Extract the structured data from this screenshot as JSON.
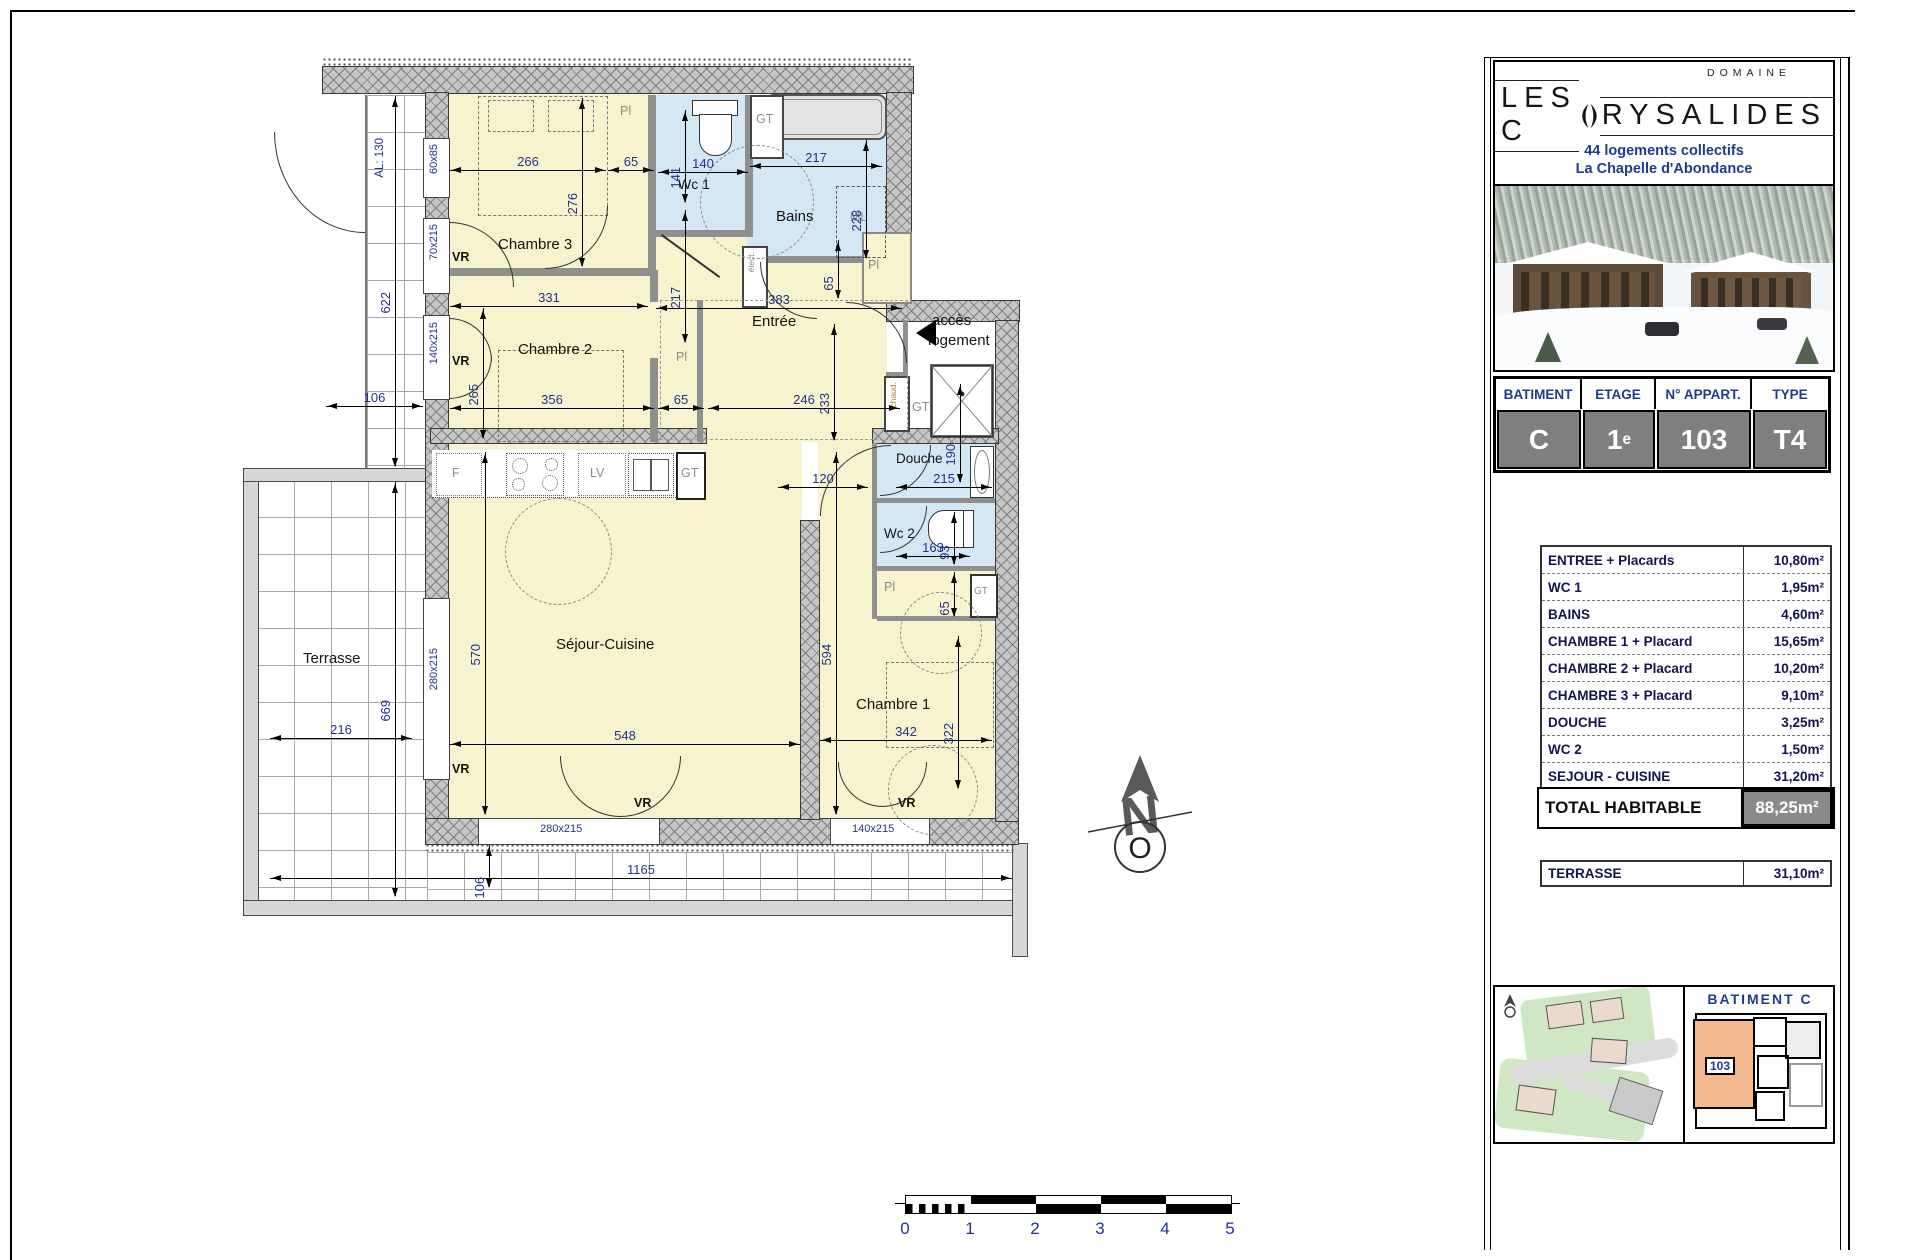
{
  "header": {
    "domaine": "DOMAINE",
    "title_left": "LES C",
    "title_right": "RYSALIDES",
    "subtitle1": "44 logements collectifs",
    "subtitle2": "La Chapelle d'Abondance"
  },
  "info": {
    "headers": [
      "BATIMENT",
      "ETAGE",
      "N° APPART.",
      "TYPE"
    ],
    "batiment": "C",
    "etage": "1",
    "etage_sup": "e",
    "appart": "103",
    "type": "T4"
  },
  "areas": {
    "rows": [
      {
        "label": "ENTREE + Placards",
        "value": "10,80m²"
      },
      {
        "label": "WC 1",
        "value": "1,95m²"
      },
      {
        "label": "BAINS",
        "value": "4,60m²"
      },
      {
        "label": "CHAMBRE 1 + Placard",
        "value": "15,65m²"
      },
      {
        "label": "CHAMBRE 2 + Placard",
        "value": "10,20m²"
      },
      {
        "label": "CHAMBRE 3 + Placard",
        "value": "9,10m²"
      },
      {
        "label": "DOUCHE",
        "value": "3,25m²"
      },
      {
        "label": "WC 2",
        "value": "1,50m²"
      },
      {
        "label": "SEJOUR - CUISINE",
        "value": "31,20m²"
      }
    ],
    "total_label": "TOTAL HABITABLE",
    "total_value": "88,25m²",
    "terrasse_label": "TERRASSE",
    "terrasse_value": "31,10m²"
  },
  "site": {
    "batiment_title": "BATIMENT  C",
    "apt_badge": "103"
  },
  "compass": {
    "n": "N",
    "o": "O"
  },
  "scalebar": {
    "ticks": [
      "0",
      "1",
      "2",
      "3",
      "4",
      "5"
    ]
  },
  "plan": {
    "rooms": {
      "chambre3": "Chambre 3",
      "chambre2": "Chambre 2",
      "wc1": "Wc 1",
      "bains": "Bains",
      "entree": "Entrée",
      "douche": "Douche",
      "wc2": "Wc 2",
      "sejour": "Séjour-Cuisine",
      "chambre1": "Chambre 1",
      "terrasse": "Terrasse"
    },
    "dims": [
      "266",
      "65",
      "140",
      "141",
      "217",
      "228",
      "276",
      "331",
      "383",
      "217",
      "265",
      "356",
      "65",
      "246",
      "106",
      "233",
      "65",
      "120",
      "215",
      "190",
      "163",
      "93",
      "65",
      "570",
      "548",
      "594",
      "342",
      "322",
      "622",
      "669",
      "216",
      "1165",
      "106"
    ],
    "windows": [
      "60x85",
      "70x215",
      "140x215",
      "280x215",
      "280x215",
      "140x215"
    ],
    "ann": {
      "al": "AL: 130",
      "vr": "VR",
      "pl": "Pl",
      "gt": "GT",
      "ml": "ML",
      "f": "F",
      "lv": "LV",
      "elect": "élect.",
      "chaud": "chaud.",
      "acces1": "accès",
      "acces2": "logement"
    }
  }
}
